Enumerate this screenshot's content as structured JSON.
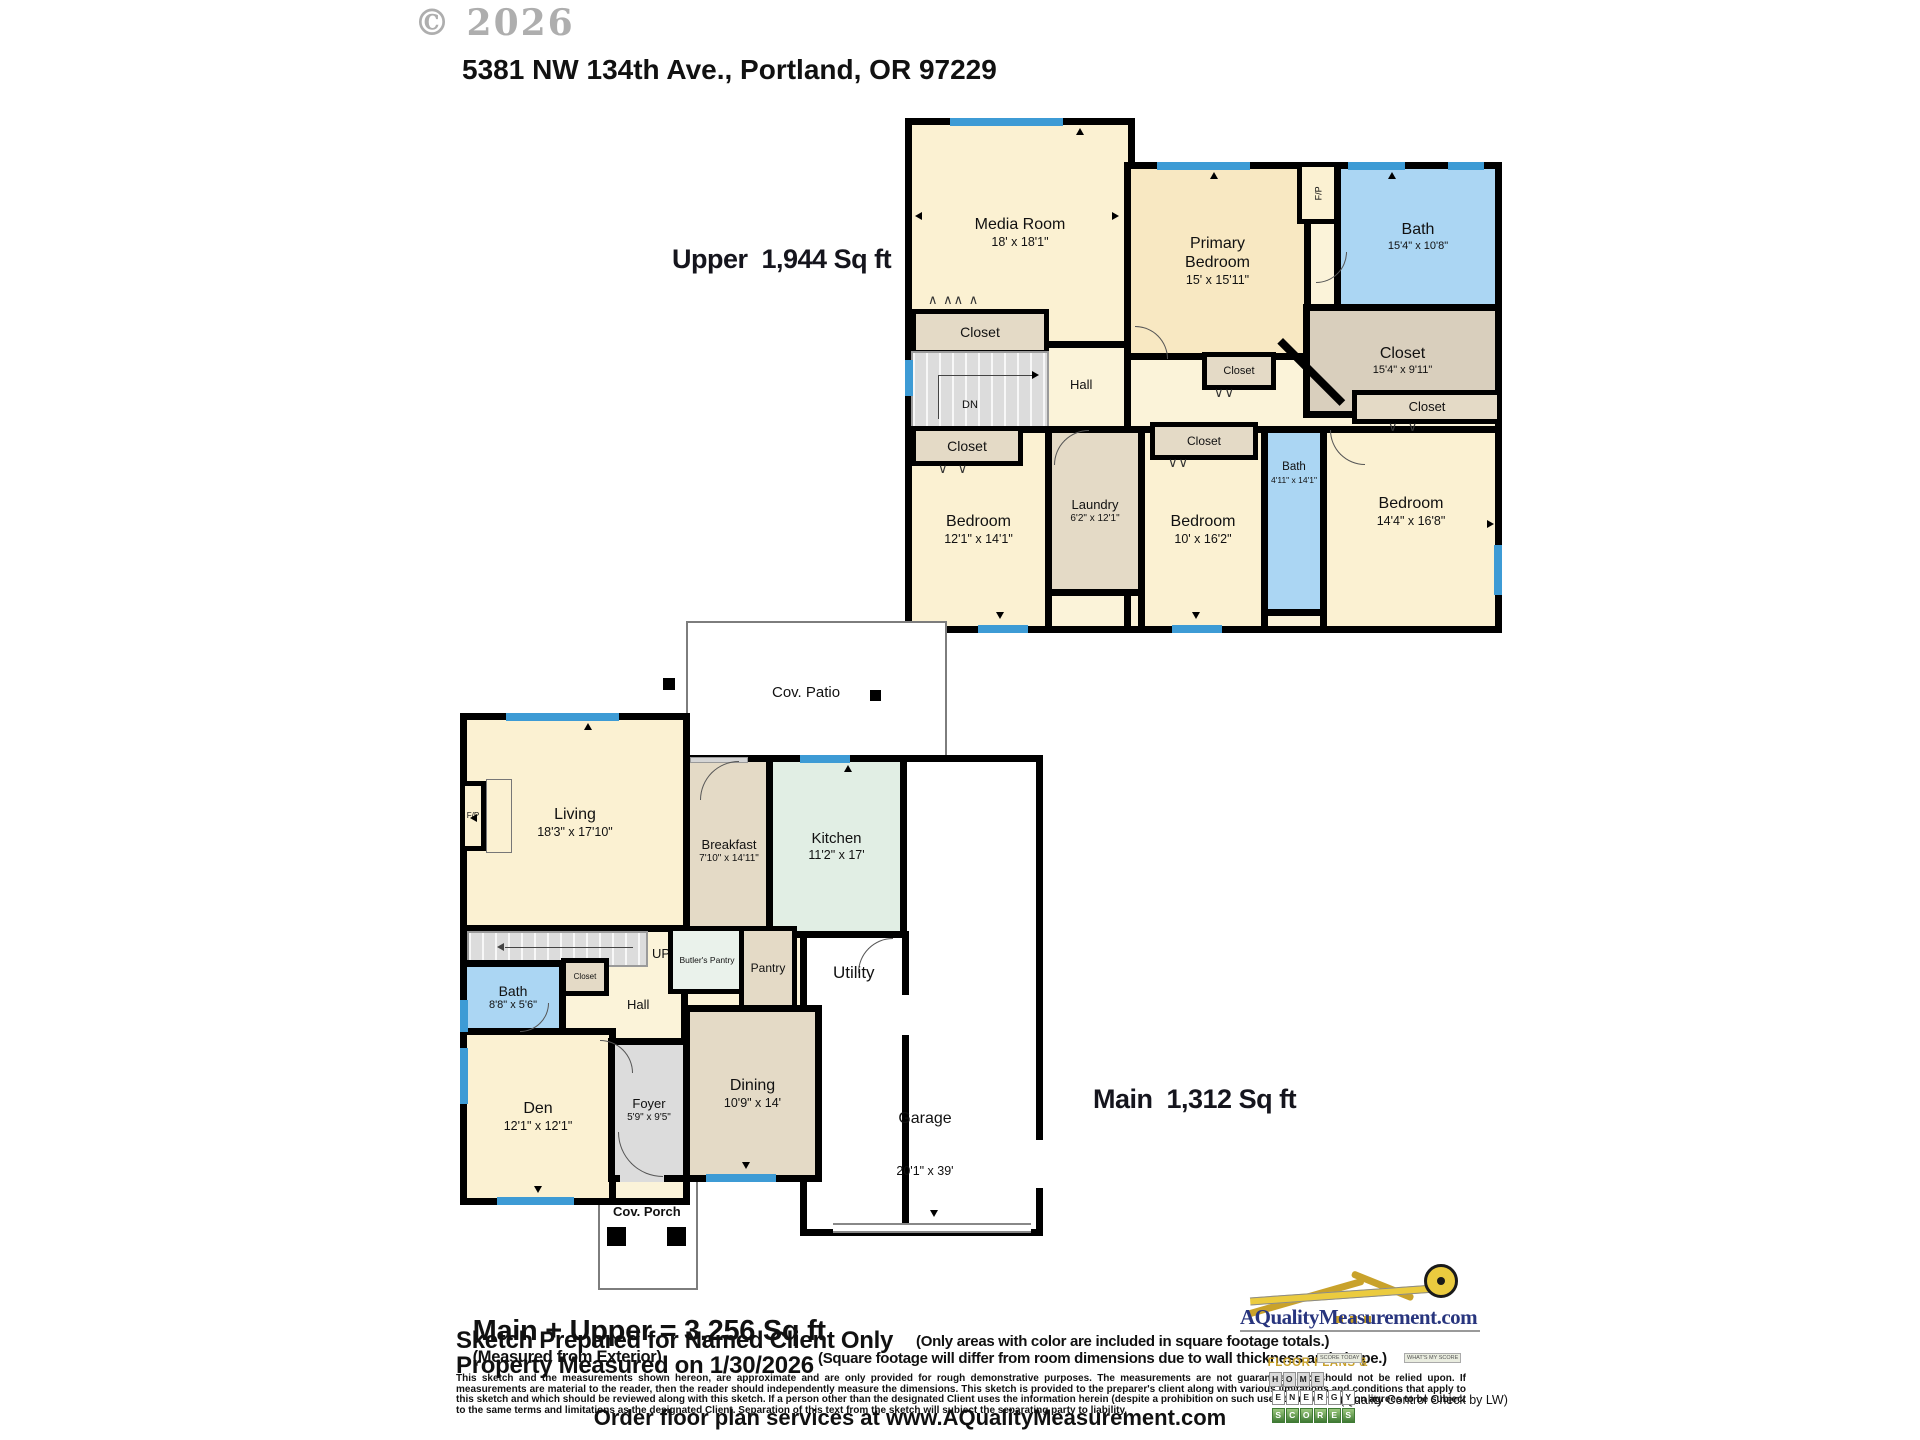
{
  "watermark": "© 2026",
  "title": "5381 NW 134th Ave., Portland, OR 97229",
  "colors": {
    "window_blue": "#3D9BD5",
    "bath_blue": "#ABD6F3",
    "room_cream": "#FBF1D2",
    "closet_tan": "#E4DAC6",
    "closet_dark_tan": "#D9CFBD",
    "kitchen_mint": "#E1EEE4",
    "stairs_gray": "#DCDCDC",
    "logo_navy": "#28357E",
    "logo_gold": "#C9A22B"
  },
  "upper": {
    "area_label": "Upper  1,944 Sq ft",
    "rooms": {
      "media": {
        "name": "Media Room",
        "dims": "18' x 18'1\""
      },
      "primary": {
        "name": "Primary Bedroom",
        "dims": "15' x 15'11\""
      },
      "fireplace": {
        "name": "F/P"
      },
      "bath": {
        "name": "Bath",
        "dims": "15'4\" x 10'8\""
      },
      "primary_closet": {
        "name": "Closet",
        "dims": "15'4\" x 9'11\""
      },
      "hall": {
        "name": "Hall"
      },
      "stairs_dn": {
        "name": "DN"
      },
      "closet_stairs": {
        "name": "Closet"
      },
      "closet_mid": {
        "name": "Closet"
      },
      "closet_right": {
        "name": "Closet"
      },
      "closet_bed_left": {
        "name": "Closet"
      },
      "closet_bed_mid": {
        "name": "Closet"
      },
      "bedroom_left": {
        "name": "Bedroom",
        "dims": "12'1\" x 14'1\""
      },
      "laundry": {
        "name": "Laundry",
        "dims": "6'2\" x 12'1\""
      },
      "bedroom_mid": {
        "name": "Bedroom",
        "dims": "10' x 16'2\""
      },
      "bath_small": {
        "name": "Bath",
        "dims": "4'11\" x 14'1\""
      },
      "bedroom_right": {
        "name": "Bedroom",
        "dims": "14'4\" x 16'8\""
      }
    }
  },
  "main": {
    "area_label": "Main  1,312 Sq ft",
    "rooms": {
      "cov_patio": {
        "name": "Cov. Patio"
      },
      "living": {
        "name": "Living",
        "dims": "18'3\" x 17'10\""
      },
      "fireplace": {
        "name": "F/P"
      },
      "breakfast": {
        "name": "Breakfast",
        "dims": "7'10\" x 14'11\""
      },
      "kitchen": {
        "name": "Kitchen",
        "dims": "11'2\" x 17'"
      },
      "stairs_up": {
        "name": "UP"
      },
      "butlers_pantry": {
        "name": "Butler's Pantry"
      },
      "pantry": {
        "name": "Pantry"
      },
      "utility": {
        "name": "Utility"
      },
      "bath": {
        "name": "Bath",
        "dims": "8'8\" x 5'6\""
      },
      "closet": {
        "name": "Closet"
      },
      "hall": {
        "name": "Hall"
      },
      "den": {
        "name": "Den",
        "dims": "12'1\" x 12'1\""
      },
      "foyer": {
        "name": "Foyer",
        "dims": "5'9\" x 9'5\""
      },
      "dining": {
        "name": "Dining",
        "dims": "10'9\" x 14'"
      },
      "garage": {
        "name": "Garage",
        "dims": "20'1\" x 39'"
      },
      "cov_porch": {
        "name": "Cov. Porch"
      }
    }
  },
  "footer": {
    "total": "Main + Upper = 3,256 Sq ft",
    "total_note": "(Measured from Exterior)",
    "prepared": "Sketch Prepared for Named Client Only",
    "measured": "Property Measured on 1/30/2026",
    "note1": "(Only areas with color are included in square footage totals.)",
    "note2": "(Square footage will differ from room dimensions due to wall thickness and shape.)",
    "disclaimer": "This sketch and the measurements shown hereon, are approximate and are only provided for rough demonstrative purposes.  The measurements are not guaranteed and should not be relied upon.  If measurements are material to the reader, then the reader should independently measure the dimensions.  This sketch is provided to the preparer's client along with various limitations and conditions that apply to this sketch and which should be reviewed along with this sketch.  If a person other than the designated Client uses the information herein (despite a prohibition on such use), then such person agrees to be subject to the same terms and limitations as the designated Client.  Separation of this text from the sketch will subject the separating party to liability.",
    "qc": "(Quality Control Check by LW)",
    "order": "Order floor plan services at www.AQualityMeasurement.com"
  },
  "logo": {
    "domain": "AQualityMeasurement.com",
    "tagline": "FLOOR PLANS &",
    "words": [
      "HOME",
      "ENERGY",
      "SCORES"
    ],
    "tiny_left": "SCORE TODAY",
    "tiny_right": "WHAT'S MY SCORE"
  },
  "icons": {
    "bifold_wide": "∧ ∧∧ ∧",
    "swing_pair": "∨  ∨",
    "swing_tight": "∨∨"
  }
}
